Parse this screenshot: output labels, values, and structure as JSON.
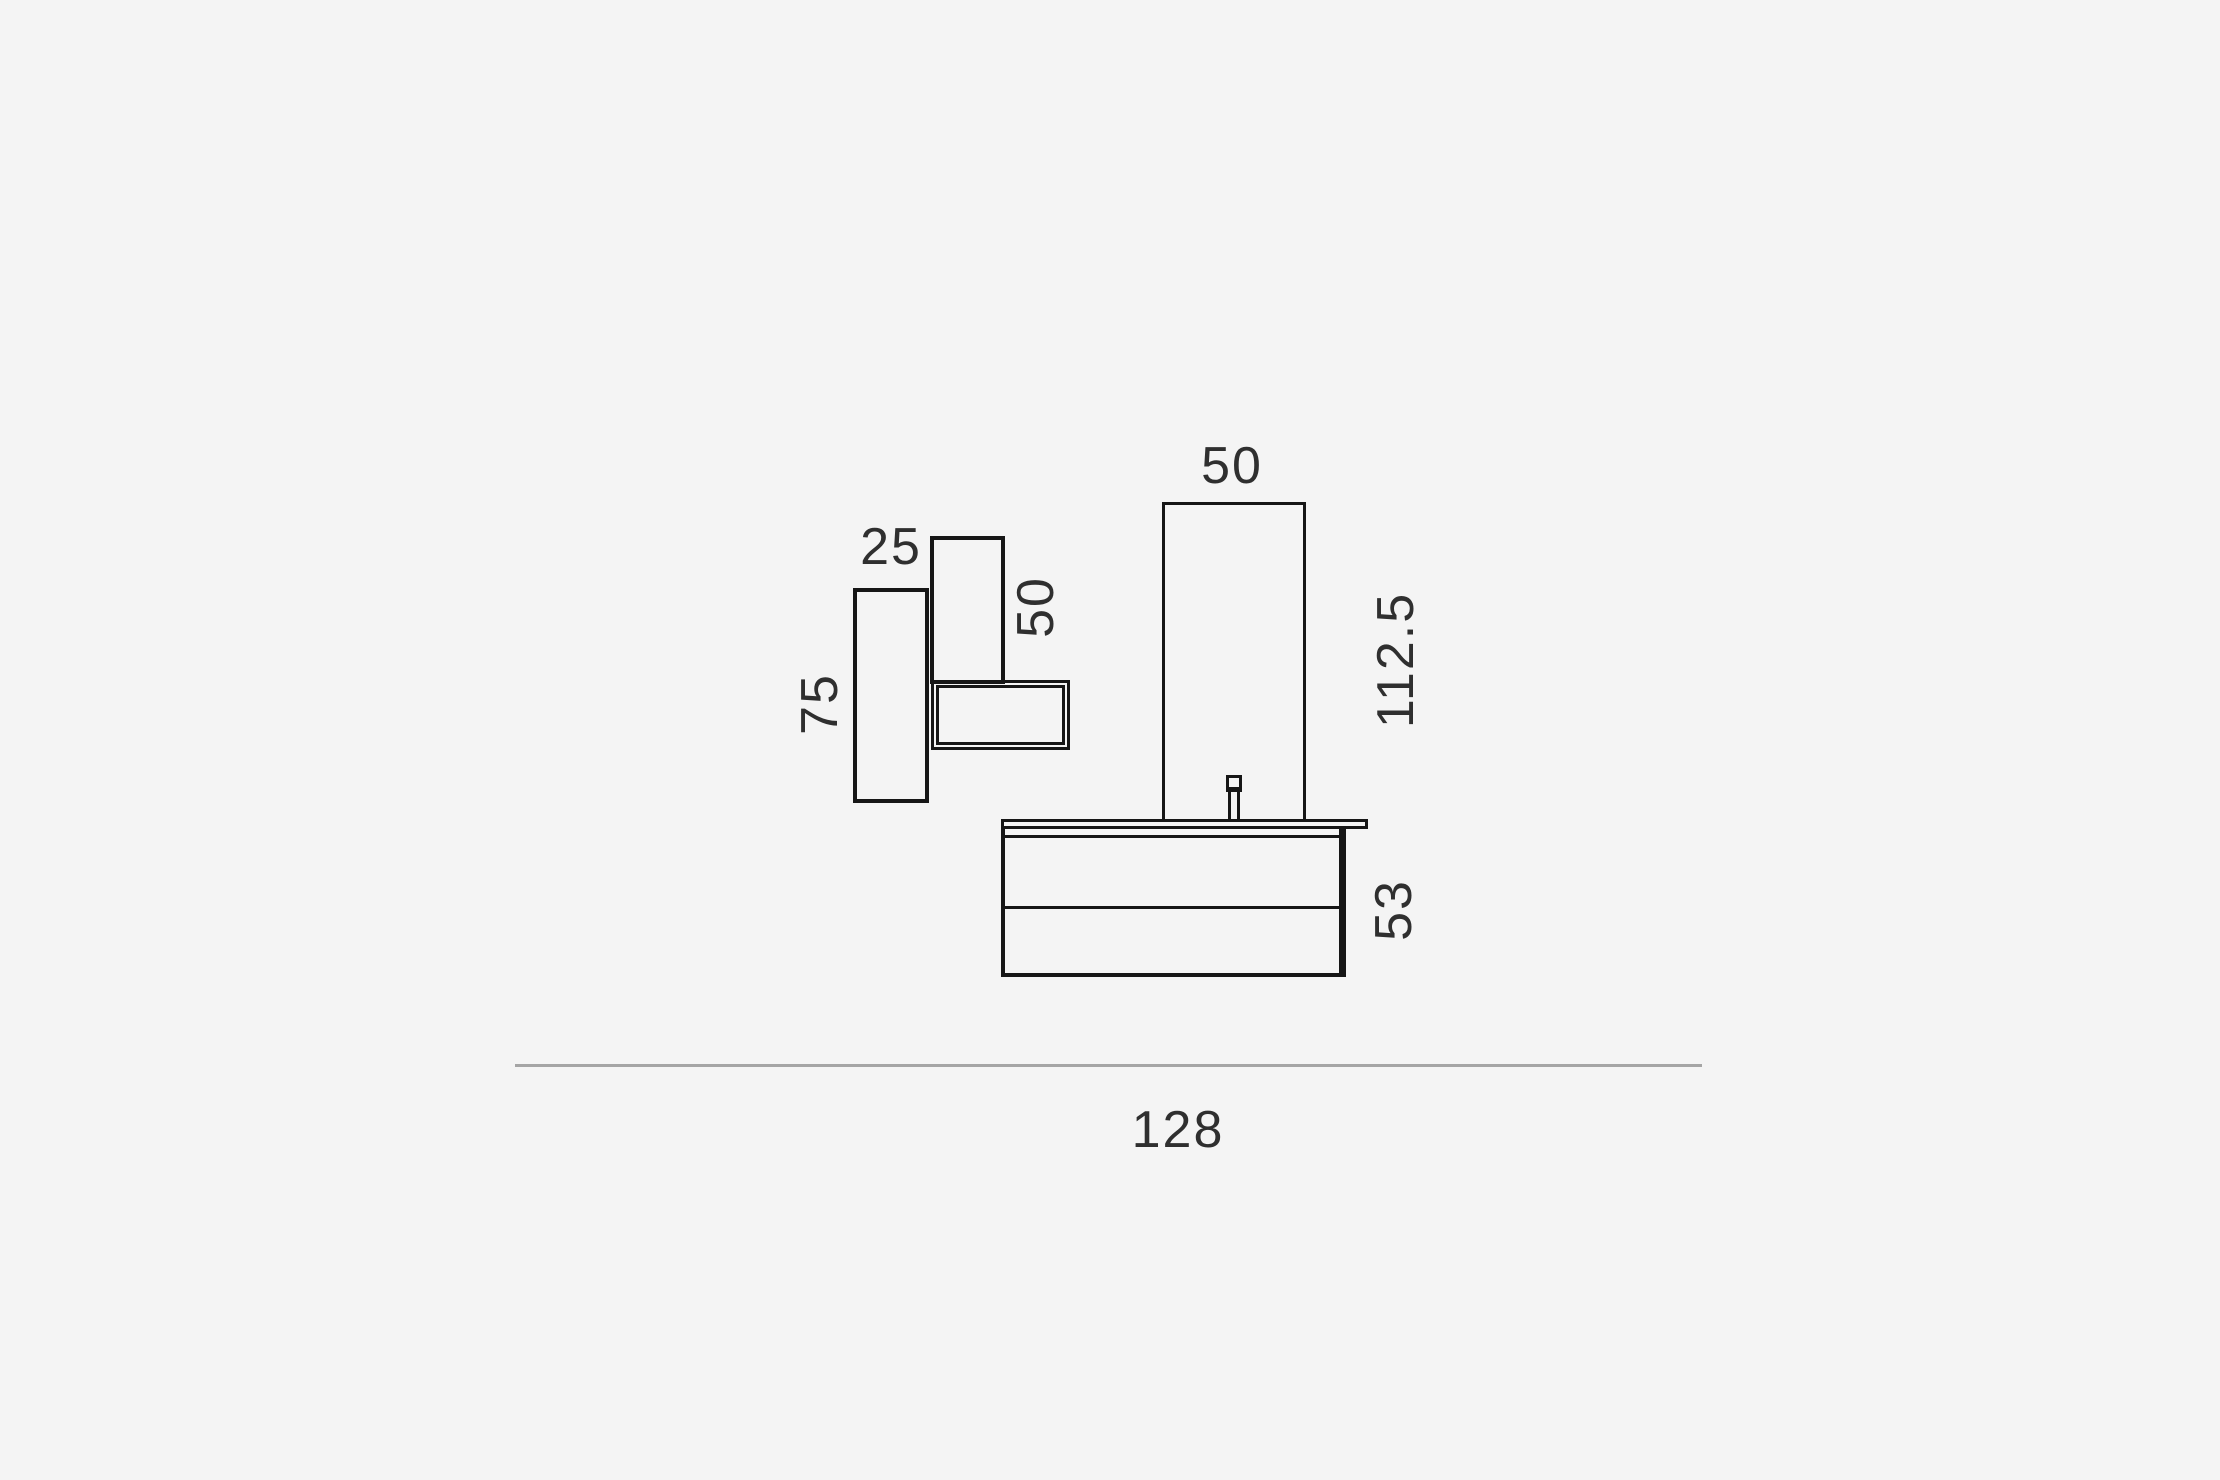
{
  "page": {
    "background_color": "#f4f4f4",
    "line_color": "#161616",
    "text_color": "#2f2f2f",
    "floor_line_color": "#a5a5a5"
  },
  "diagram": {
    "type": "furniture-dimension-drawing",
    "dimensions": {
      "tall_cabinet_height": "75",
      "small_cabinet_width": "25",
      "small_cabinet_height": "50",
      "mirror_width": "50",
      "mirror_height": "112.5",
      "vanity_height": "53",
      "overall_width": "128"
    }
  }
}
